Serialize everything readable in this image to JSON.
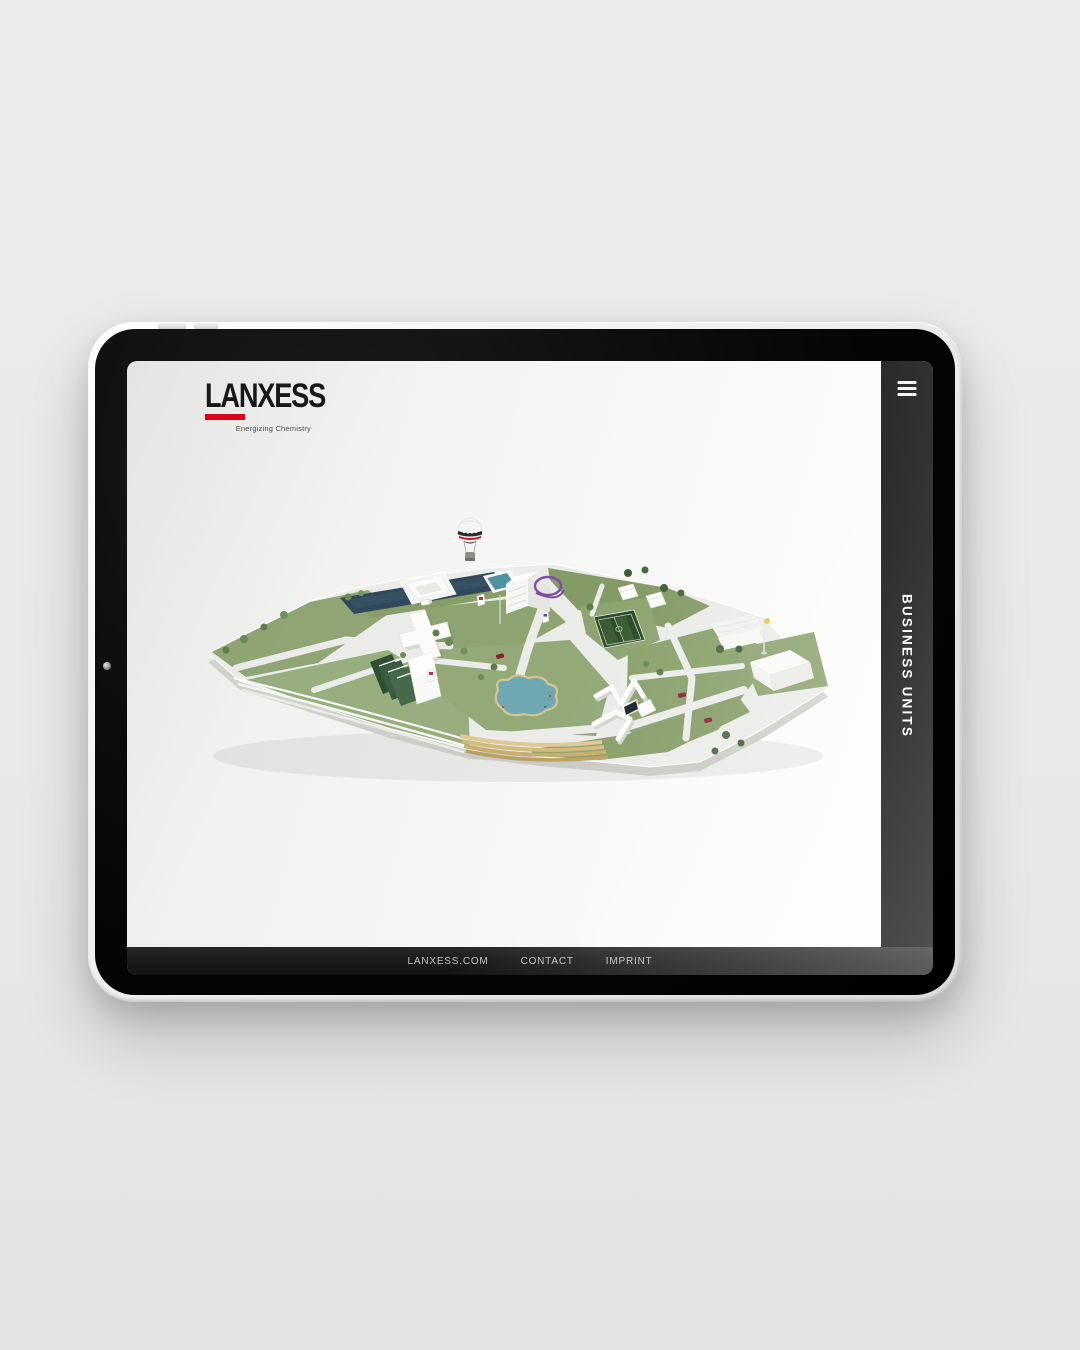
{
  "brand": {
    "name": "LANXESS",
    "tagline": "Energizing Chemistry",
    "accent_color": "#e2001a"
  },
  "nav": {
    "menu_icon": "hamburger-icon"
  },
  "sidebar": {
    "label": "BUSINESS UNITS",
    "background": "#0a0a0a",
    "text_color": "#ffffff"
  },
  "footer": {
    "links": [
      "LANXESS.COM",
      "CONTACT",
      "IMPRINT"
    ],
    "background": "#1a1a1a",
    "text_color": "#c3c3c3"
  },
  "map": {
    "kind": "isometric-campus-illustration",
    "features": [
      "hot-air-balloon",
      "water-basin",
      "swimming-pool",
      "office-tower",
      "cross-building",
      "solar-striped-building",
      "soccer-field",
      "pond-with-sand-terraces",
      "maze-walls",
      "amphitheater",
      "slanted-hall",
      "flagpole",
      "trees",
      "red-cars",
      "billboards",
      "purple-loop"
    ],
    "palette": {
      "lawn": "#8fa573",
      "path": "#ebecea",
      "water_dark": "#30495a",
      "pool": "#4f93a3",
      "pond": "#6fa8b2",
      "sand": "#d2bd82",
      "soccer_field": "#2c4a28",
      "car": "#8e2030",
      "loop": "#7b4fa3"
    }
  }
}
